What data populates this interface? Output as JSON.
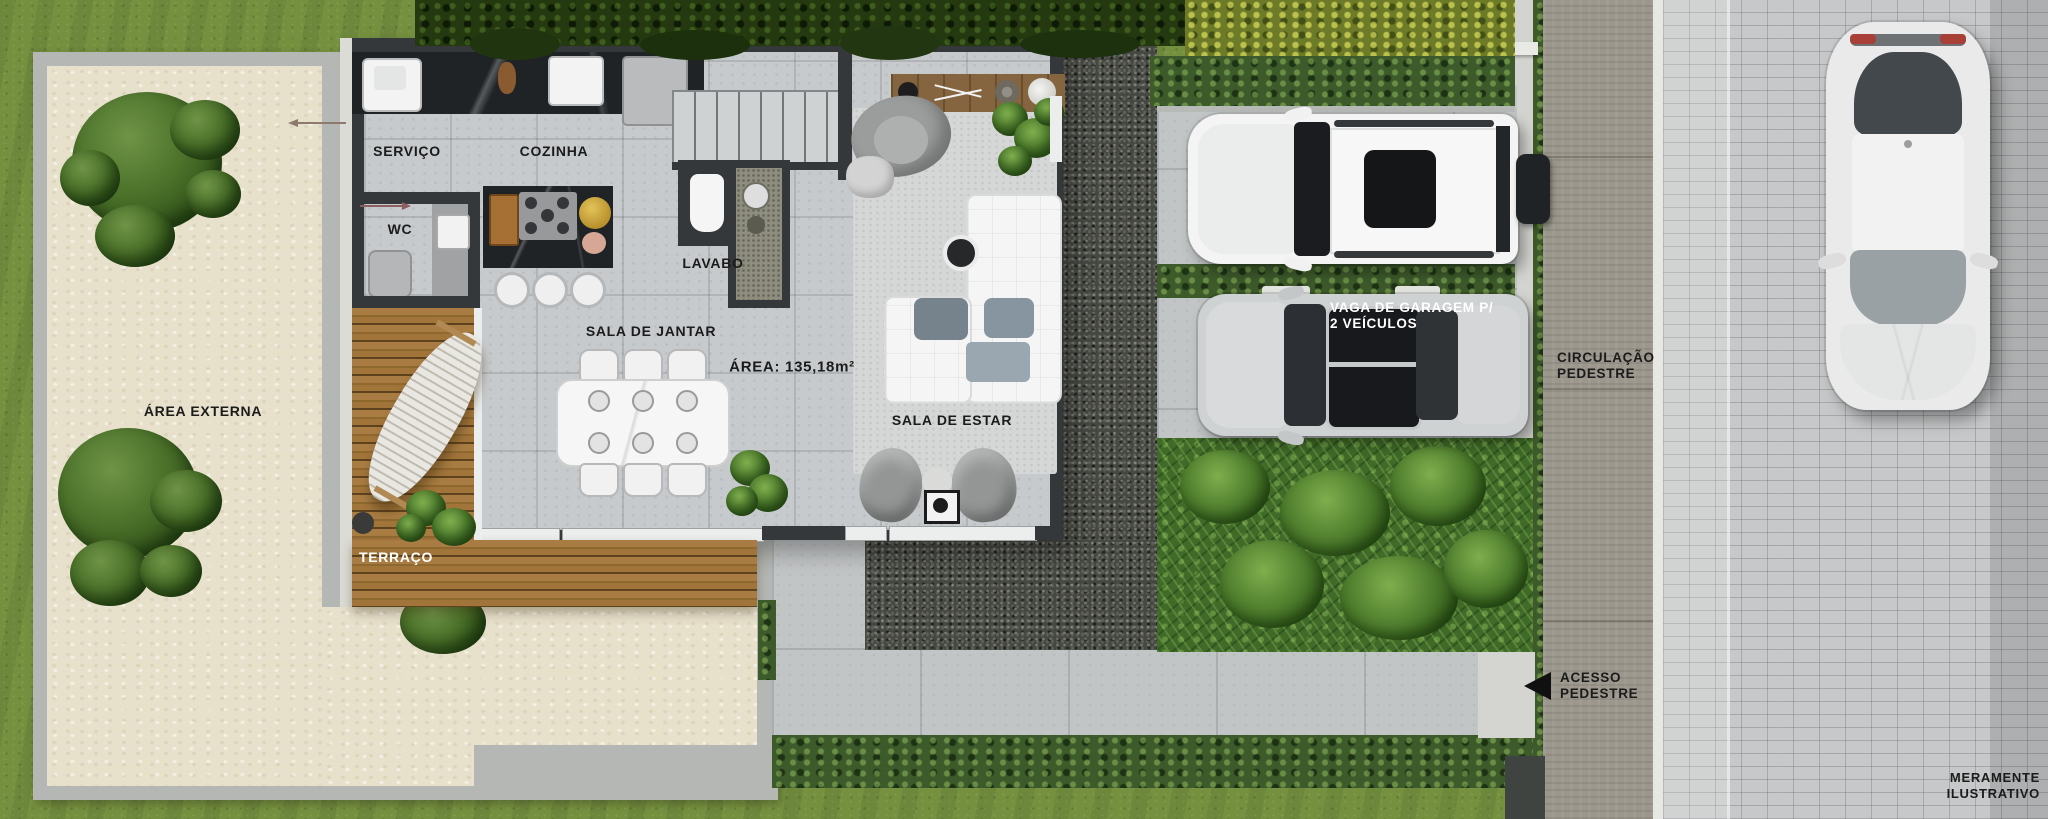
{
  "rooms": {
    "servico": "SERVIÇO",
    "cozinha": "COZINHA",
    "wc": "WC",
    "lavabo": "LAVABO",
    "sala_de_jantar": "SALA DE JANTAR",
    "sala_de_estar": "SALA DE ESTAR",
    "terraco": "TERRAÇO",
    "area_externa": "ÁREA EXTERNA"
  },
  "area": {
    "label": "ÁREA: 135,18m²"
  },
  "garage": {
    "line1": "VAGA DE GARAGEM P/",
    "line2": "2 VEÍCULOS"
  },
  "circulation": {
    "line1": "CIRCULAÇÃO",
    "line2": "PEDESTRE"
  },
  "access": {
    "line1": "ACESSO",
    "line2": "PEDESTRE"
  },
  "disclaimer": {
    "line1": "MERAMENTE",
    "line2": "ILUSTRATIVO"
  },
  "icons": {
    "pedestrian_access_arrow": "left-triangle-arrow"
  },
  "colors": {
    "grass": "#75913f",
    "sand": "#e7e0cb",
    "wood_deck": "#9c7038",
    "house_wall": "#35383b",
    "concrete_floor": "#c7cacc",
    "gravel": "#454741",
    "hedge_green": "#3d5a2b",
    "pedestrian_path": "#9b978c",
    "sidewalk_pavers": "#c6c8c9",
    "label_text": "#1b1b1b",
    "label_text_light": "#ffffff"
  }
}
